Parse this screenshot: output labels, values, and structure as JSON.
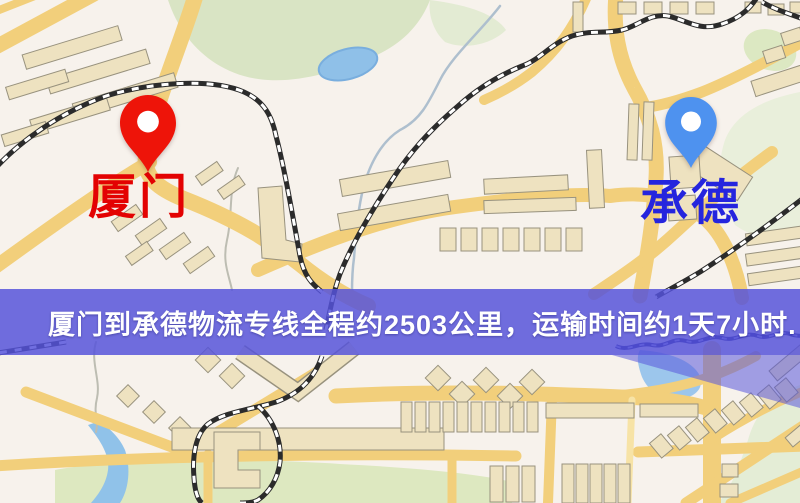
{
  "map": {
    "origin": {
      "label": "厦门",
      "pin_color": "#ee1409",
      "label_color": "#e30202",
      "pin_icon": "red-pin-icon"
    },
    "destination": {
      "label": "承德",
      "pin_color": "#4e92ef",
      "label_color": "#2525de",
      "pin_icon": "blue-pin-icon"
    }
  },
  "banner": {
    "text": "厦门到承德物流专线全程约2503公里，运输时间约1天7小时.",
    "distance_km": "2503",
    "duration": "1天7小时",
    "bg_color": "#5552da",
    "text_color": "#ffffff"
  },
  "map_style": {
    "background_color": "#f7f2ec",
    "road_color": "#f2cf7b",
    "building_color": "#eee2c0",
    "park_color": "#d9e4c4",
    "water_color": "#8fc0e8",
    "railway_color": "#2b2b2b",
    "overlay_color": "#5a57dd"
  }
}
